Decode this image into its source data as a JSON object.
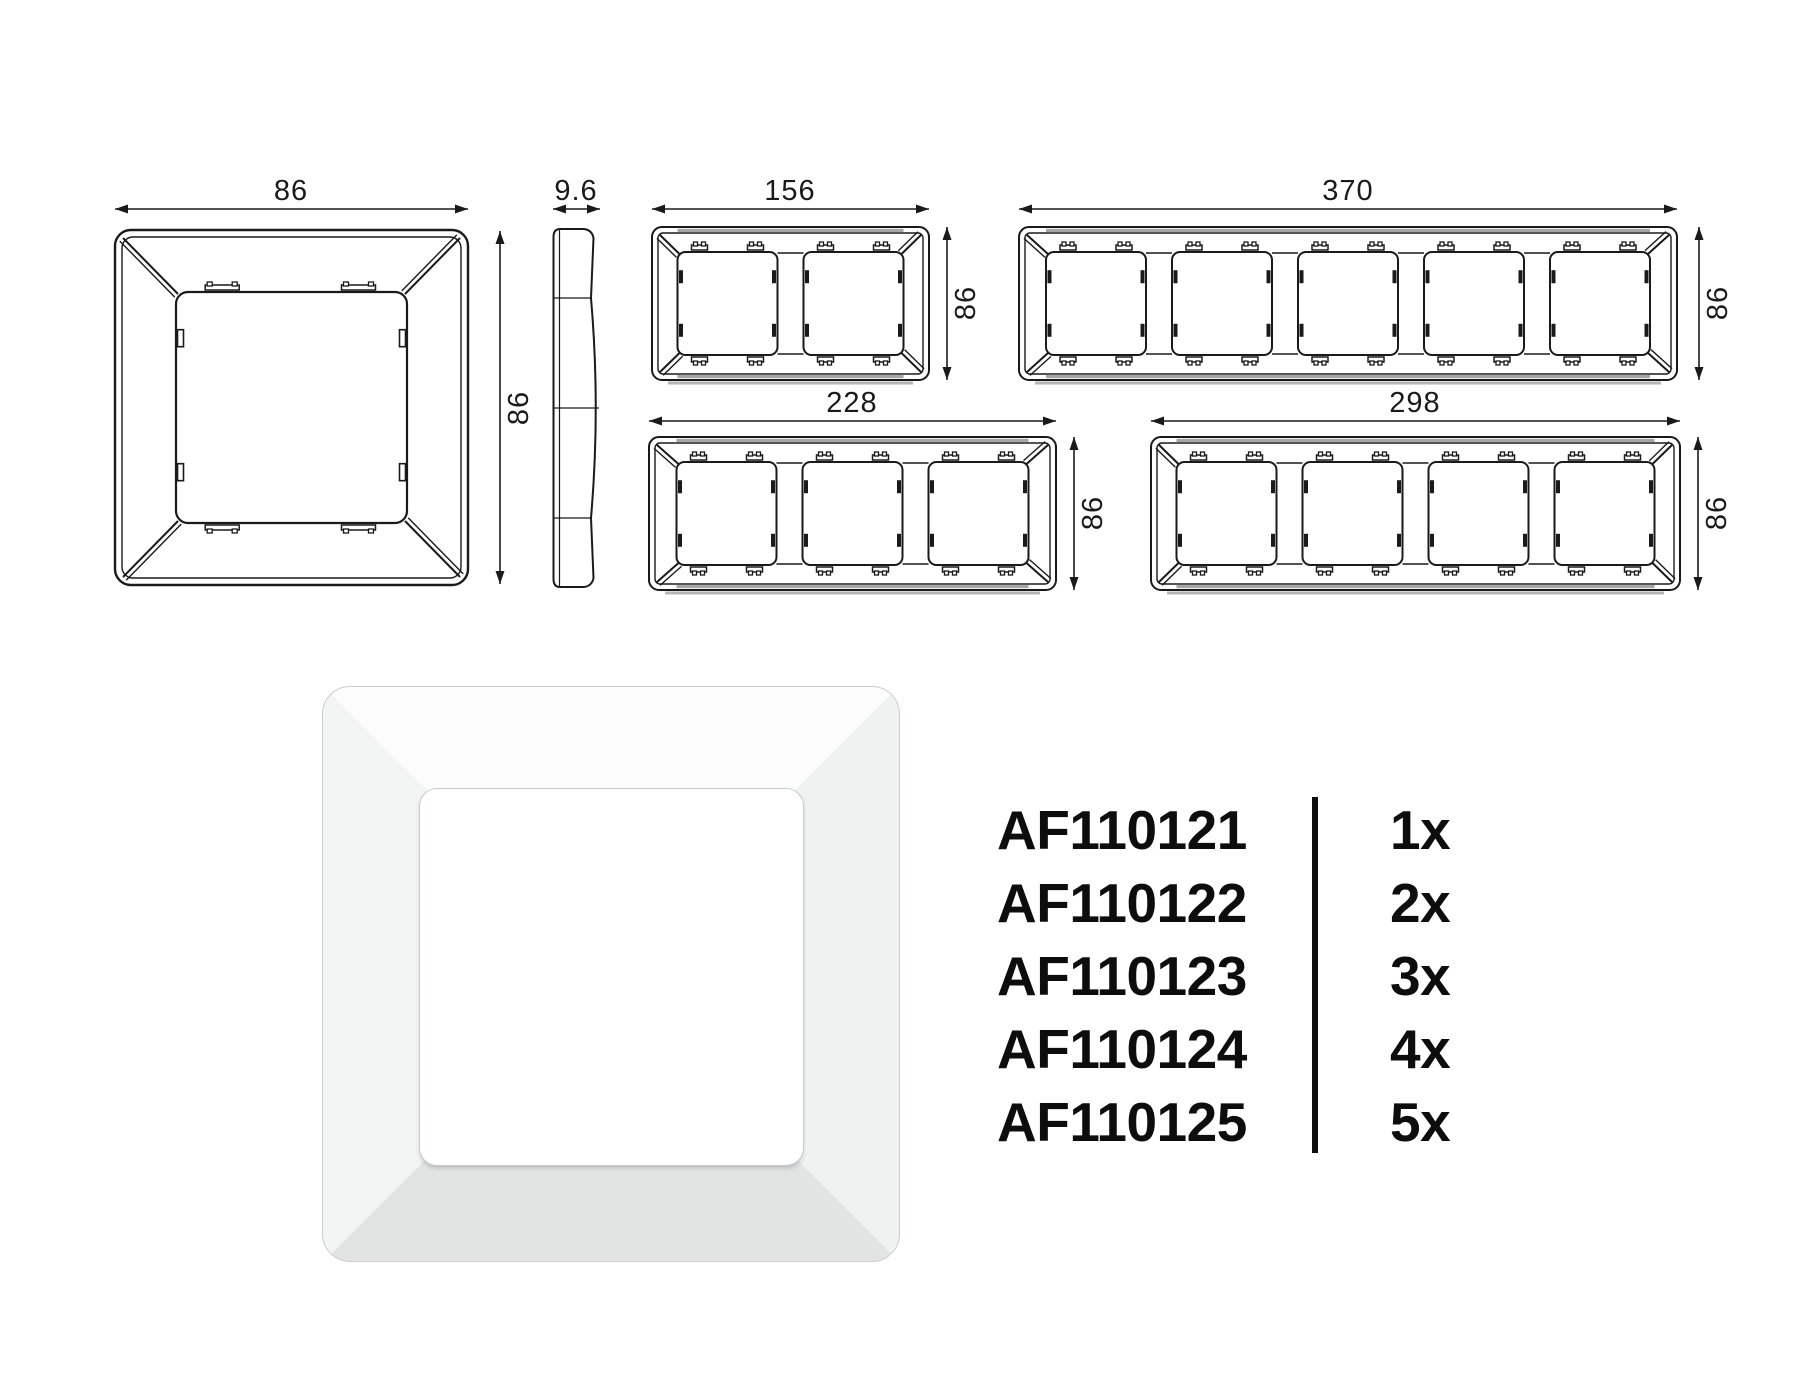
{
  "page": {
    "background_color": "#ffffff",
    "line_color": "#1a1a1a",
    "shading_gray": "#a6a6a6",
    "text_color": "#0d0d0d"
  },
  "technical_drawings": {
    "front_view_1gang": {
      "width_label": "86",
      "height_label": "86"
    },
    "side_view": {
      "depth_label": "9.6"
    },
    "front_view_2gang": {
      "width_label": "156",
      "height_label": "86"
    },
    "front_view_5gang": {
      "width_label": "370",
      "height_label": "86"
    },
    "front_view_3gang": {
      "width_label": "228",
      "height_label": "86"
    },
    "front_view_4gang": {
      "width_label": "298",
      "height_label": "86"
    }
  },
  "product_photo": {
    "frame_color": "#ffffff",
    "bevel_shadow_color": "#e3e5e5"
  },
  "parts_list": {
    "rows": [
      {
        "code": "AF110121",
        "qty": "1x"
      },
      {
        "code": "AF110122",
        "qty": "2x"
      },
      {
        "code": "AF110123",
        "qty": "3x"
      },
      {
        "code": "AF110124",
        "qty": "4x"
      },
      {
        "code": "AF110125",
        "qty": "5x"
      }
    ]
  }
}
